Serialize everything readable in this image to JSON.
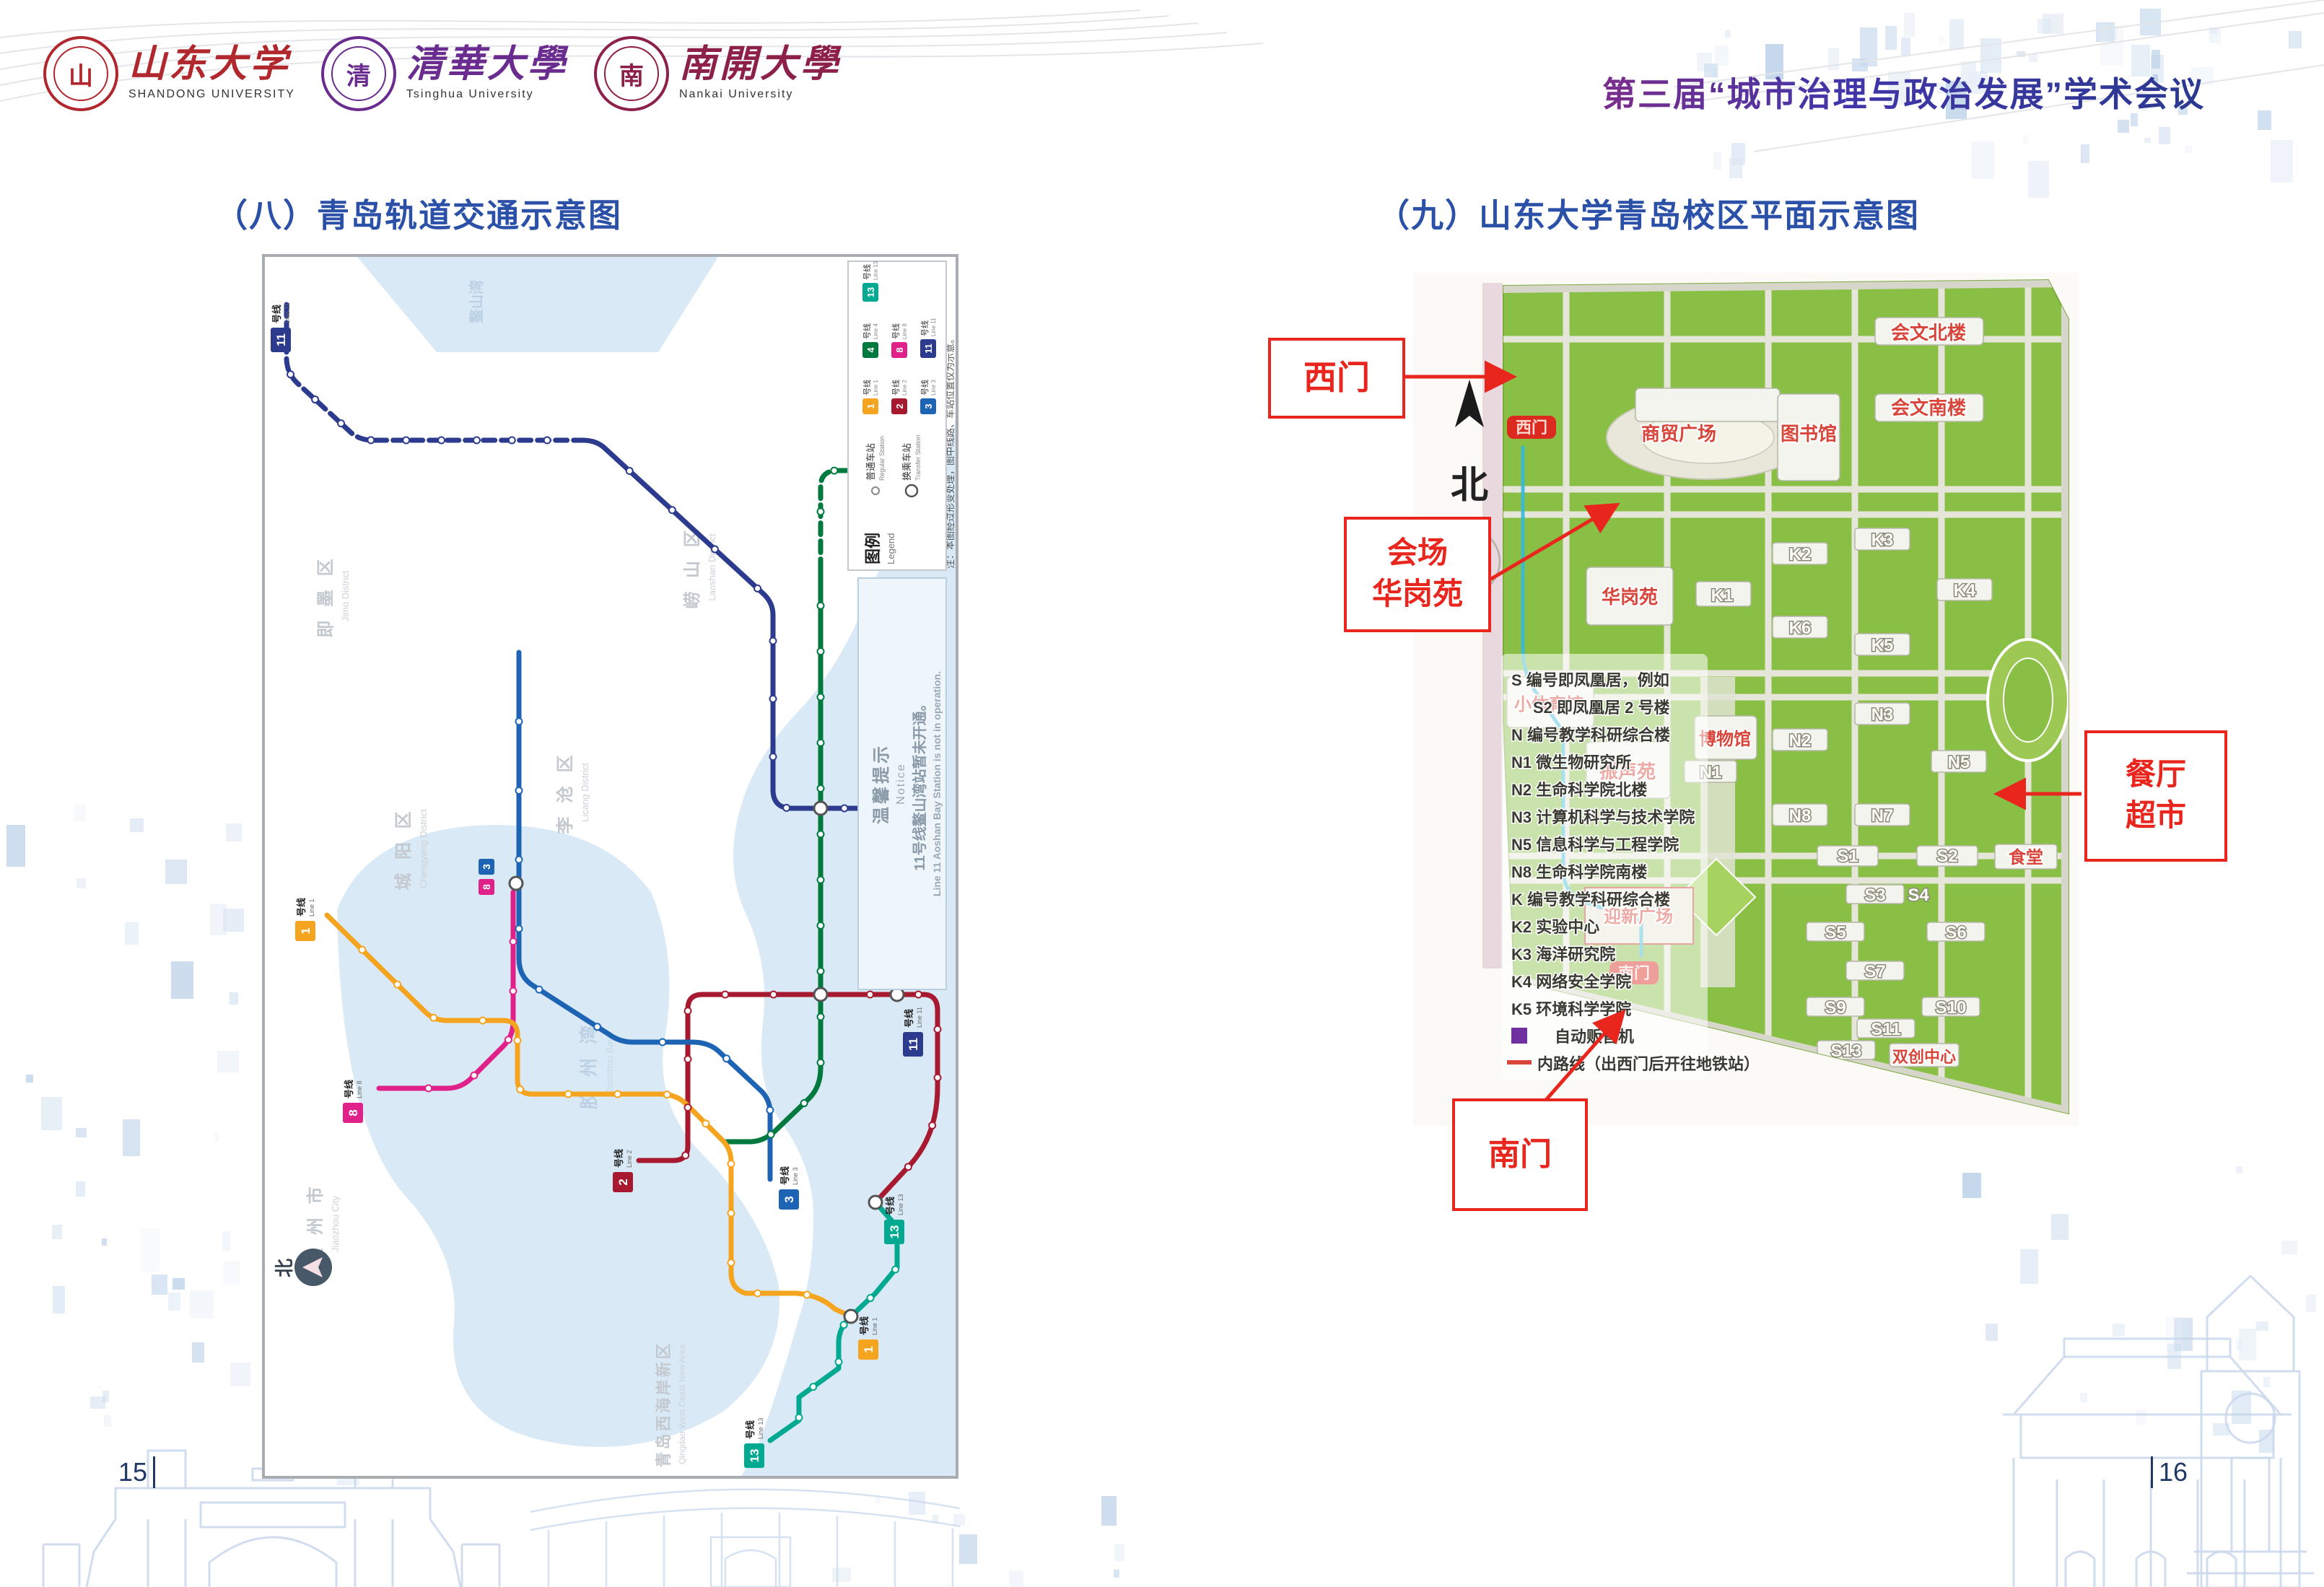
{
  "header": {
    "logos": [
      {
        "name": "shandong-university",
        "seal_char": "山",
        "cn": "山东大学",
        "en": "SHANDONG UNIVERSITY",
        "color": "#b0282d"
      },
      {
        "name": "tsinghua-university",
        "seal_char": "清",
        "cn": "清華大學",
        "en": "Tsinghua University",
        "color": "#6a2c8f"
      },
      {
        "name": "nankai-university",
        "seal_char": "南",
        "cn": "南開大學",
        "en": "Nankai University",
        "color": "#8d2048"
      }
    ],
    "conference_title": "第三届“城市治理与政治发展”学术会议"
  },
  "sections": {
    "left_title": "（八）青岛轨道交通示意图",
    "right_title": "（九）山东大学青岛校区平面示意图"
  },
  "metro_map": {
    "note": "注：本图经过形变处理，图中线路、车站位置仅为示意。",
    "legend": {
      "title_cn": "图例",
      "title_en": "Legend",
      "regular_cn": "普通车站",
      "regular_en": "Regular Station",
      "transfer_cn": "换乘车站",
      "transfer_en": "Transfer Station"
    },
    "notice": {
      "title_cn": "温馨提示",
      "title_en": "Notice",
      "line_cn": "11号线鳌山湾站暂未开通。",
      "line_en": "Line 11 Aoshan Bay Station is not in operation."
    },
    "compass": "北",
    "lines": [
      {
        "id": "1",
        "cn": "号线",
        "en": "Line 1",
        "color": "#f5a41f"
      },
      {
        "id": "2",
        "cn": "号线",
        "en": "Line 2",
        "color": "#a6192e"
      },
      {
        "id": "3",
        "cn": "号线",
        "en": "Line 3",
        "color": "#1e64b4"
      },
      {
        "id": "4",
        "cn": "号线",
        "en": "Line 4",
        "color": "#00793e"
      },
      {
        "id": "8",
        "cn": "号线",
        "en": "Line 8",
        "color": "#e0218a"
      },
      {
        "id": "11",
        "cn": "号线",
        "en": "Line 11",
        "color": "#2d3b8e"
      },
      {
        "id": "13",
        "cn": "号线",
        "en": "Line 13",
        "color": "#00a98f"
      }
    ],
    "districts": [
      {
        "cn": "即 墨 区",
        "en": "Jimo District"
      },
      {
        "cn": "城 阳 区",
        "en": "Chengyang District"
      },
      {
        "cn": "李 沧 区",
        "en": "Licang District"
      },
      {
        "cn": "崂 山 区",
        "en": "Laoshan District"
      },
      {
        "cn": "胶 州 市",
        "en": "Jiaozhou City"
      },
      {
        "cn": "青岛西海岸新区",
        "en": "Qingdao West Coast New Area"
      }
    ],
    "waters": [
      {
        "cn": "鳌山湾",
        "en": "Aoshan Bay"
      },
      {
        "cn": "黄 海",
        "en": "The Yellow Sea"
      },
      {
        "cn": "胶 州 湾",
        "en": "Jiaozhou Bay"
      }
    ]
  },
  "campus_map": {
    "compass": "北",
    "gate_labels": {
      "west": "西门",
      "south": "南门"
    },
    "red_labels": [
      "商贸广场",
      "图书馆",
      "会文北楼",
      "会文南楼",
      "华岗苑",
      "振声苑",
      "小体育馆",
      "博物馆",
      "迎新广场",
      "食堂",
      "双创中心"
    ],
    "codes": [
      "K1",
      "K2",
      "K3",
      "K4",
      "K5",
      "K6",
      "N1",
      "N2",
      "N3",
      "N5",
      "N7",
      "N8",
      "S1",
      "S2",
      "S3",
      "S4",
      "S5",
      "S6",
      "S7",
      "S9",
      "S10",
      "S11",
      "S13"
    ],
    "legend_lines": [
      "S 编号即凤凰居，例如",
      "S2 即凤凰居 2 号楼",
      "N 编号教学科研综合楼",
      "N1 微生物研究所",
      "N2 生命科学院北楼",
      "N3 计算机科学与技术学院",
      "N5 信息科学与工程学院",
      "N8 生命科学院南楼",
      "K 编号教学科研综合楼",
      "K2 实验中心",
      "K3 海洋研究院",
      "K4 网络安全学院",
      "K5 环境科学学院",
      "自动贩售机",
      "内路线（出西门后开往地铁站）"
    ]
  },
  "annotations": {
    "west_gate": "西门",
    "venue_line1": "会场",
    "venue_line2": "华岗苑",
    "canteen_line1": "餐厅",
    "canteen_line2": "超市",
    "south_gate": "南门"
  },
  "footer": {
    "left_page": "15",
    "right_page": "16"
  }
}
